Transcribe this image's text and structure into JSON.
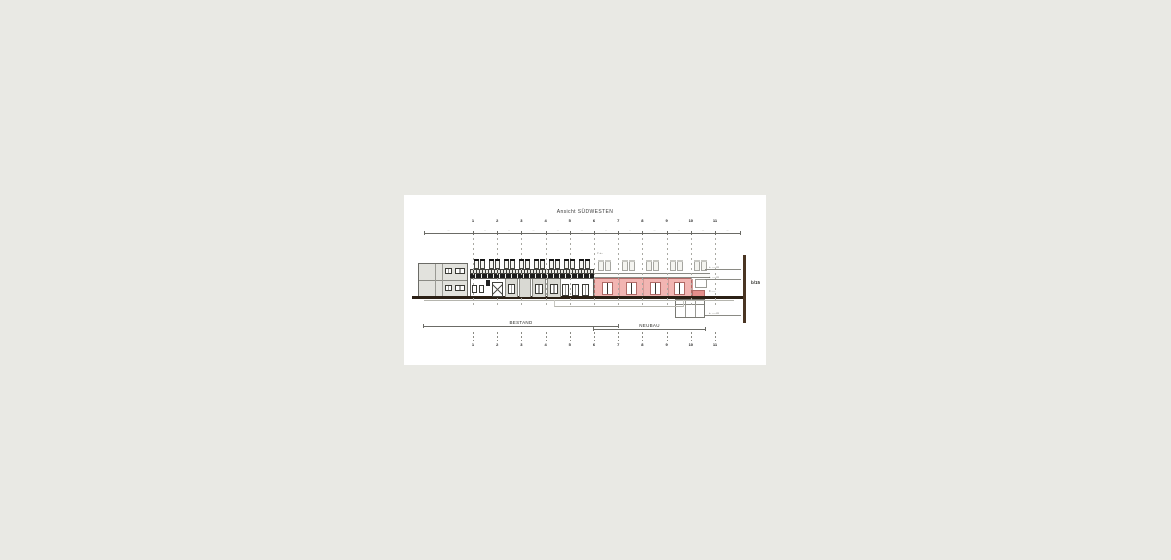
{
  "window": {
    "background": "#e9e9e4",
    "canvas_background": "#ffffff"
  },
  "drawing": {
    "title": "Ansicht SÜDWESTEN",
    "sheet_ref": "b/15",
    "grid_numbers": [
      "1",
      "2",
      "3",
      "4",
      "5",
      "6",
      "7",
      "8",
      "9",
      "10",
      "11"
    ],
    "dim_marks": [
      "‥",
      "‥",
      "‥",
      "‥",
      "‥",
      "‥",
      "‥",
      "‥",
      "‥",
      "‥",
      "‥",
      "‥"
    ],
    "region_labels": {
      "bestand": "BESTAND",
      "neubau": "NEUBAU"
    },
    "levels": [
      {
        "text": "+ ‥‥ m"
      },
      {
        "text": "+ ‥‥ m"
      },
      {
        "text": "± ‥‥"
      },
      {
        "text": "+ ‥‥ m"
      }
    ],
    "roof_marker": "▿ +‥",
    "colors": {
      "pink_facade": "#f2b5b2",
      "pink_dark": "#e58f8c",
      "ground": "#2b2015",
      "section_marker": "#4a3523",
      "gray_facade": "#e2e2dd",
      "dark_band": "#1c1c1c"
    }
  }
}
